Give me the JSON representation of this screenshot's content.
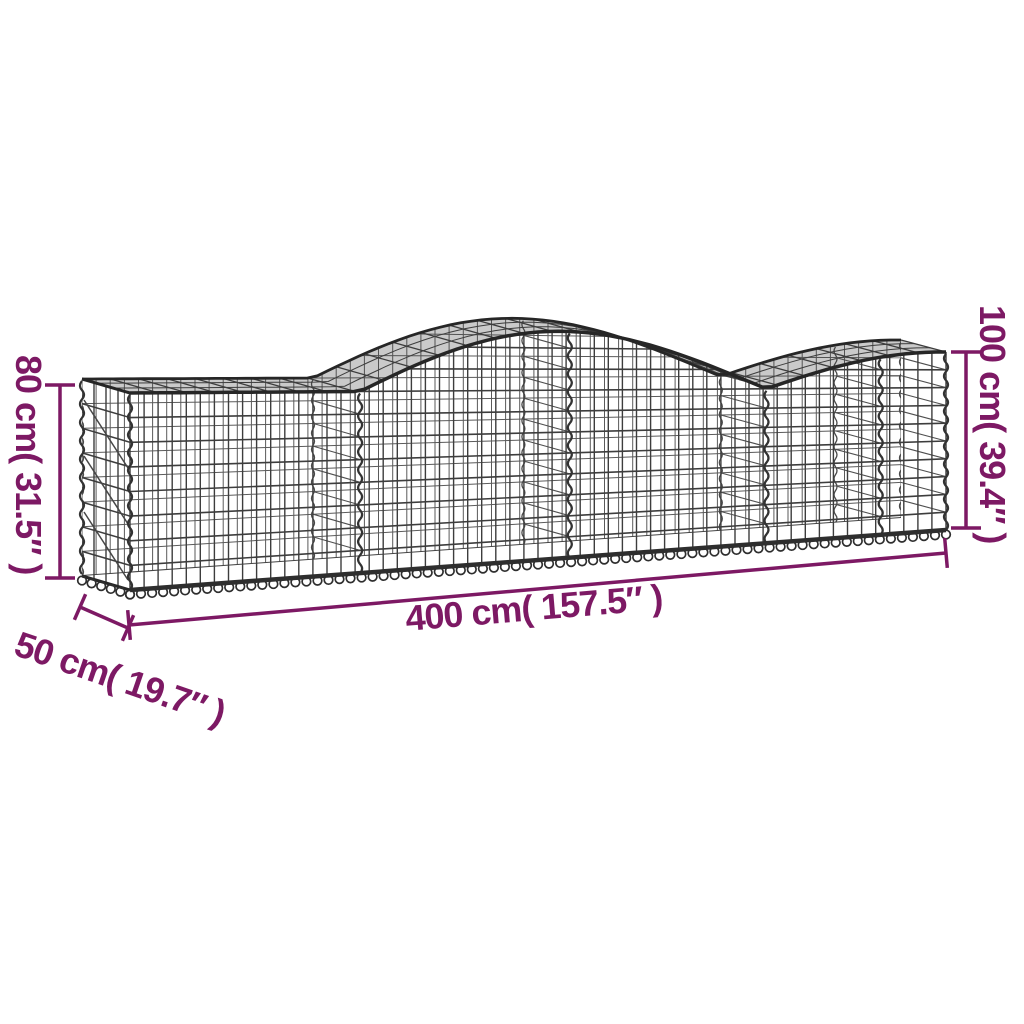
{
  "colors": {
    "background": "#ffffff",
    "dimension": "#7d1964",
    "mesh_dark": "#262626",
    "mesh_mid": "#3d3d3d",
    "mesh_light": "#5a5a5a",
    "spiral": "#333333"
  },
  "dimensions": {
    "height_left": {
      "label": "80 cm( 31.5″ )",
      "value_cm": 80,
      "value_in": 31.5
    },
    "height_right": {
      "label": "100 cm( 39.4″ )",
      "value_cm": 100,
      "value_in": 39.4
    },
    "length": {
      "label": "400 cm( 157.5″ )",
      "value_cm": 400,
      "value_in": 157.5
    },
    "depth": {
      "label": "50 cm( 19.7″ )",
      "value_cm": 50,
      "value_in": 19.7
    }
  }
}
